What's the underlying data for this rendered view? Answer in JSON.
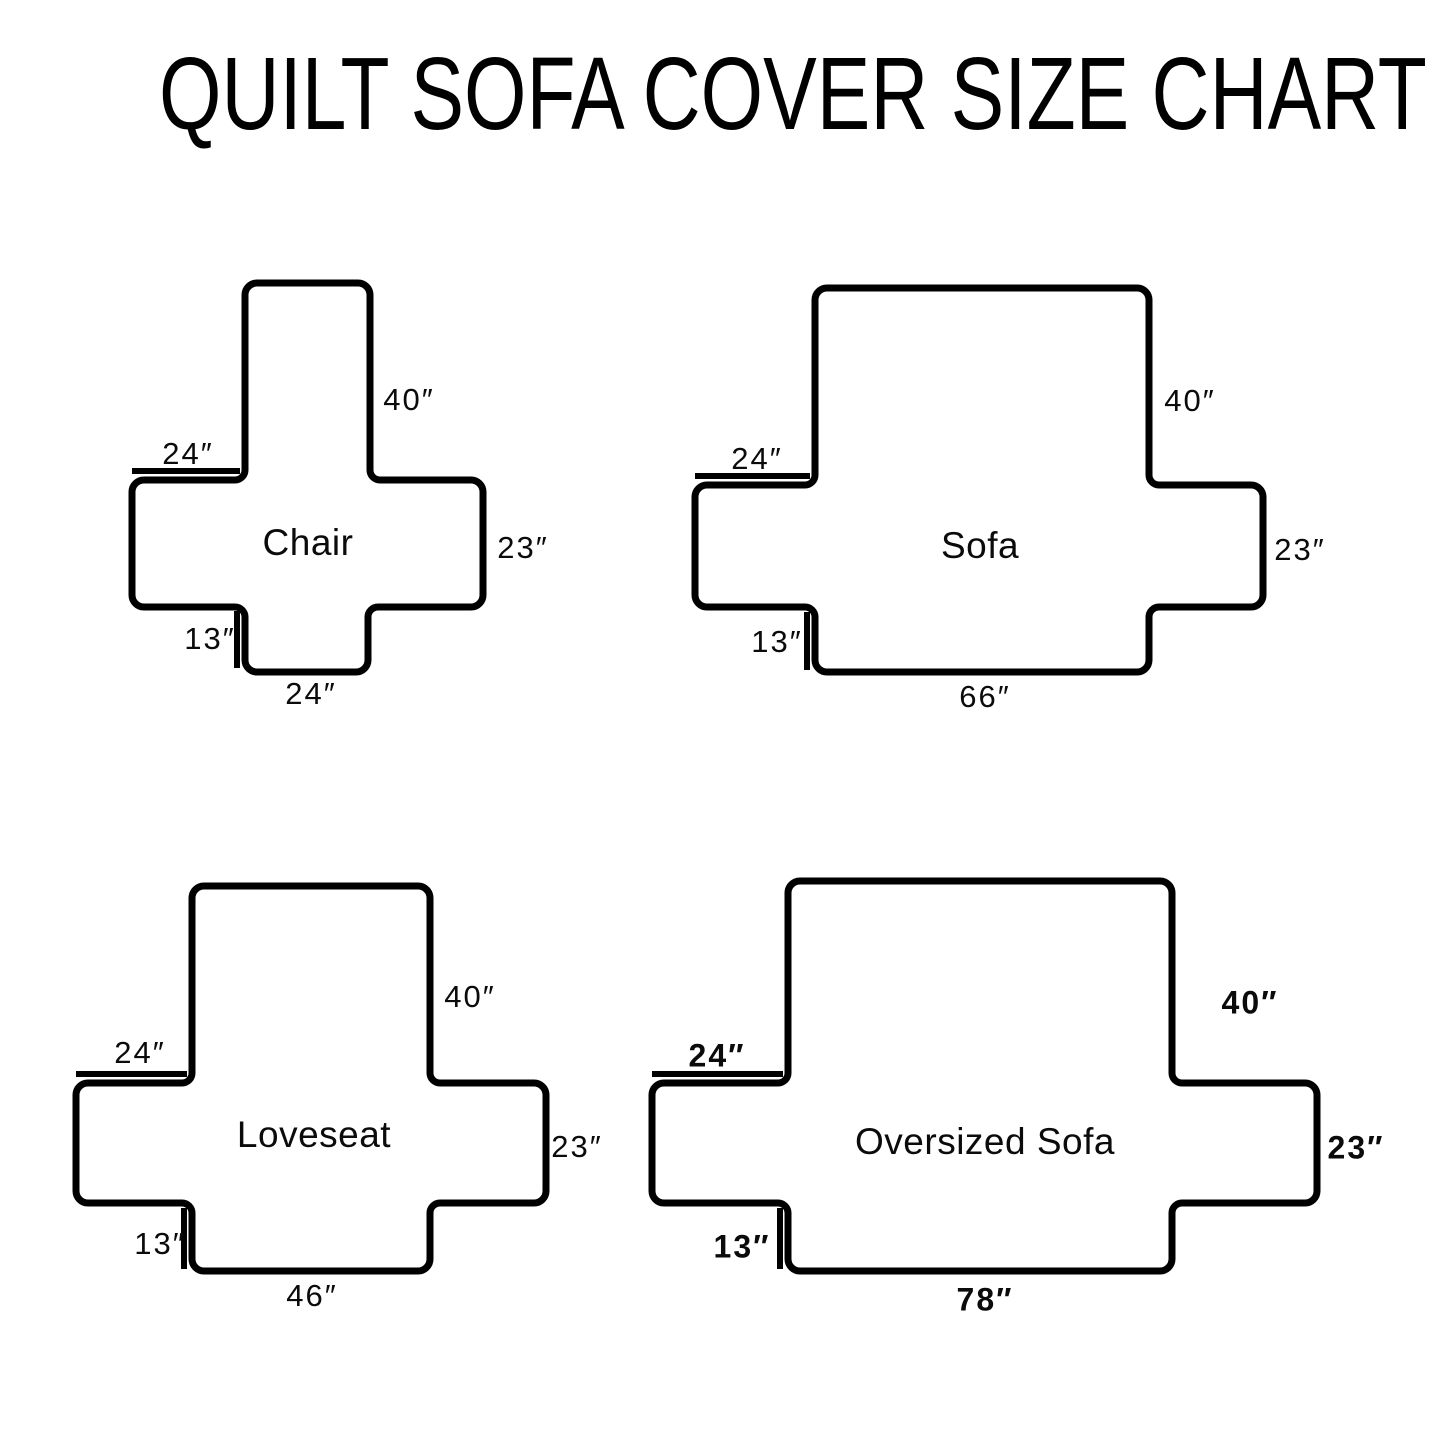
{
  "title": "QUILT SOFA COVER SIZE CHART",
  "colors": {
    "line": "#000000",
    "background": "#ffffff",
    "text": "#0b0b0b"
  },
  "diagrams": [
    {
      "name": "Chair",
      "back_height": "40″",
      "back_width": "24″",
      "side_height": "23″",
      "front_drop": "13″",
      "front_width": "24″"
    },
    {
      "name": "Sofa",
      "back_height": "40″",
      "back_width": "24″",
      "side_height": "23″",
      "front_drop": "13″",
      "front_width": "66″"
    },
    {
      "name": "Loveseat",
      "back_height": "40″",
      "back_width": "24″",
      "side_height": "23″",
      "front_drop": "13″",
      "front_width": "46″"
    },
    {
      "name": "Oversized Sofa",
      "back_height": "40″",
      "back_width": "24″",
      "side_height": "23″",
      "front_drop": "13″",
      "front_width": "78″"
    }
  ]
}
